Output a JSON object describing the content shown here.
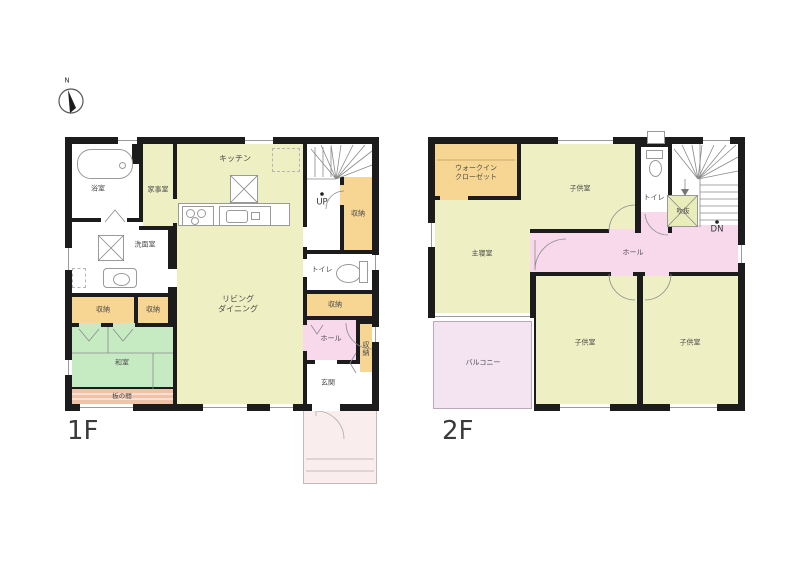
{
  "compass": {
    "north": "N"
  },
  "floor1": {
    "label": "1F",
    "rooms": {
      "bath": "浴室",
      "utility": "家事室",
      "kitchen": "キッチン",
      "washroom": "洗面室",
      "storage_a": "収納",
      "storage_b": "収納",
      "storage_stairs": "収納",
      "storage_mid": "収納",
      "storage_entry": "収納",
      "living1": "リビング",
      "living2": "ダイニング",
      "toilet": "トイレ",
      "hall": "ホール",
      "washitsu": "和室",
      "itanoma": "板の間",
      "genkan": "玄関",
      "up": "UP"
    }
  },
  "floor2": {
    "label": "2F",
    "rooms": {
      "wic1": "ウォークイン",
      "wic2": "クローゼット",
      "kids_top": "子供室",
      "toilet": "トイレ",
      "void": "吹抜",
      "master": "主寝室",
      "hall": "ホール",
      "balcony": "バルコニー",
      "kids_left": "子供室",
      "kids_right": "子供室",
      "dn": "DN"
    }
  },
  "colors": {
    "wall": "#1c1c1c",
    "room_yellow_green": "#eef0c4",
    "storage_orange": "#f6d692",
    "tatami_green": "#c6ebc3",
    "hall_pink": "#f8d9ec",
    "balcony_pink": "#f4e4f1",
    "porch_pink": "#faeded",
    "wood_strip": "#f0c2a8"
  }
}
